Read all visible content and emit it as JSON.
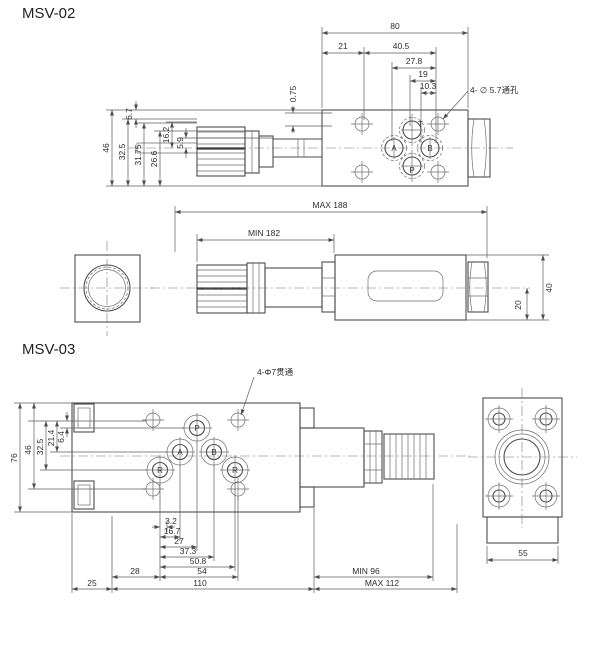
{
  "drawing": {
    "background": "#ffffff",
    "line_color": "#4d4d4d",
    "text_color": "#2e2e2e"
  },
  "msv02": {
    "title": "MSV-02",
    "hole_note": "4- ∅ 5.7通孔",
    "top_dims": {
      "overall": "80",
      "d21": "21",
      "d40_5": "40.5",
      "d27_8": "27.8",
      "d19": "19",
      "d10_3": "10.3"
    },
    "left_dims": {
      "d46": "46",
      "d32_5": "32.5",
      "d31_75": "31.75",
      "d26_6": "26.6",
      "d16_2": "16.2",
      "d5_9": "5.9",
      "d6_7": "6.7",
      "d0_75": "0.75"
    },
    "ports": {
      "t": "T",
      "a": "A",
      "b": "B",
      "p": "P"
    },
    "front_dims": {
      "max_length": "MAX  188",
      "min_length": "MIN  182",
      "d20": "20",
      "d40": "40"
    }
  },
  "msv03": {
    "title": "MSV-03",
    "hole_note": "4-Φ7贯通",
    "ports": {
      "p": "P",
      "a": "A",
      "b": "B",
      "r_left": "R",
      "r_right": "R"
    },
    "left_dims": {
      "d76": "76",
      "d46": "46",
      "d32_5": "32.5",
      "d21_4": "21.4",
      "d6_4": "6.4"
    },
    "bottom_dims": {
      "d3_2": "3.2",
      "d16_7": "16.7",
      "d27": "27",
      "d37_3": "37.3",
      "d50_8": "50.8",
      "d54": "54",
      "d28": "28",
      "d25": "25",
      "d110": "110"
    },
    "length_dims": {
      "min_length": "MIN  96",
      "max_length": "MAX  112"
    },
    "side_dim": "55"
  }
}
